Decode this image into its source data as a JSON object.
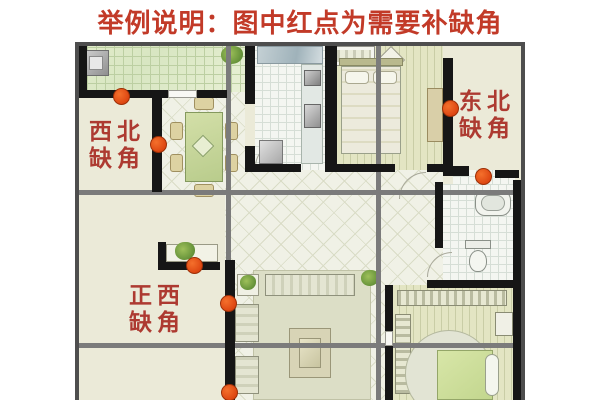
{
  "title": {
    "text": "举例说明：图中红点为需要补缺角"
  },
  "plan": {
    "labels": {
      "northwest": {
        "line1": "西北",
        "line2": "缺角"
      },
      "northeast": {
        "line1": "东北",
        "line2": "缺角"
      },
      "west": {
        "line1": "正西",
        "line2": "缺角"
      }
    },
    "dots": [
      {
        "name": "northwest-top-wall",
        "x": 46,
        "y": 54
      },
      {
        "name": "northwest-side-wall",
        "x": 83,
        "y": 102
      },
      {
        "name": "northeast-bedroom-wall",
        "x": 375,
        "y": 66
      },
      {
        "name": "northeast-entry-wall",
        "x": 408,
        "y": 134
      },
      {
        "name": "west-shelf-wall",
        "x": 119,
        "y": 223
      },
      {
        "name": "west-hall-wall-upper",
        "x": 153,
        "y": 261
      },
      {
        "name": "west-hall-wall-lower",
        "x": 154,
        "y": 350
      }
    ],
    "colors": {
      "title_red": "#c23a28",
      "label_red": "#ad3a31",
      "dot_orange": "#e8531a",
      "wall_black": "#161616",
      "grid_gray": "#7b7b7b",
      "floor_cream": "#ebead8"
    }
  }
}
